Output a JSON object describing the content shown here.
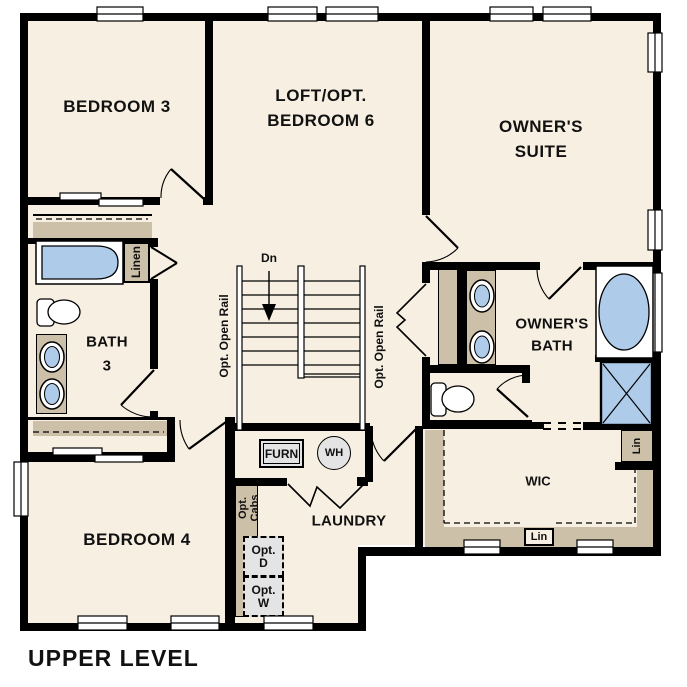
{
  "page_title": "UPPER LEVEL",
  "colors": {
    "floor": "#f7efe2",
    "casework": "#cdc0a8",
    "fixture_blue": "#aecbe9",
    "appliance_gray": "#e4e4e4",
    "wall": "#000000",
    "text": "#111111"
  },
  "rooms": {
    "bedroom3": "BEDROOM 3",
    "loft": {
      "line1": "LOFT/OPT.",
      "line2": "BEDROOM 6"
    },
    "owners_suite": {
      "line1": "OWNER'S",
      "line2": "SUITE"
    },
    "bath3": {
      "line1": "BATH",
      "line2": "3"
    },
    "owners_bath": {
      "line1": "OWNER'S",
      "line2": "BATH"
    },
    "bedroom4": "BEDROOM 4",
    "laundry": "LAUNDRY",
    "wic": "WIC"
  },
  "annotations": {
    "down": "Dn",
    "opt_open_rail": "Opt. Open Rail",
    "linen": "Linen",
    "lin": "Lin",
    "furnace": "FURN",
    "water_heater": "WH",
    "opt_cabs": {
      "line1": "Opt.",
      "line2": "Cabs"
    },
    "opt_dryer": {
      "line1": "Opt.",
      "line2": "D"
    },
    "opt_washer": {
      "line1": "Opt.",
      "line2": "W"
    }
  }
}
